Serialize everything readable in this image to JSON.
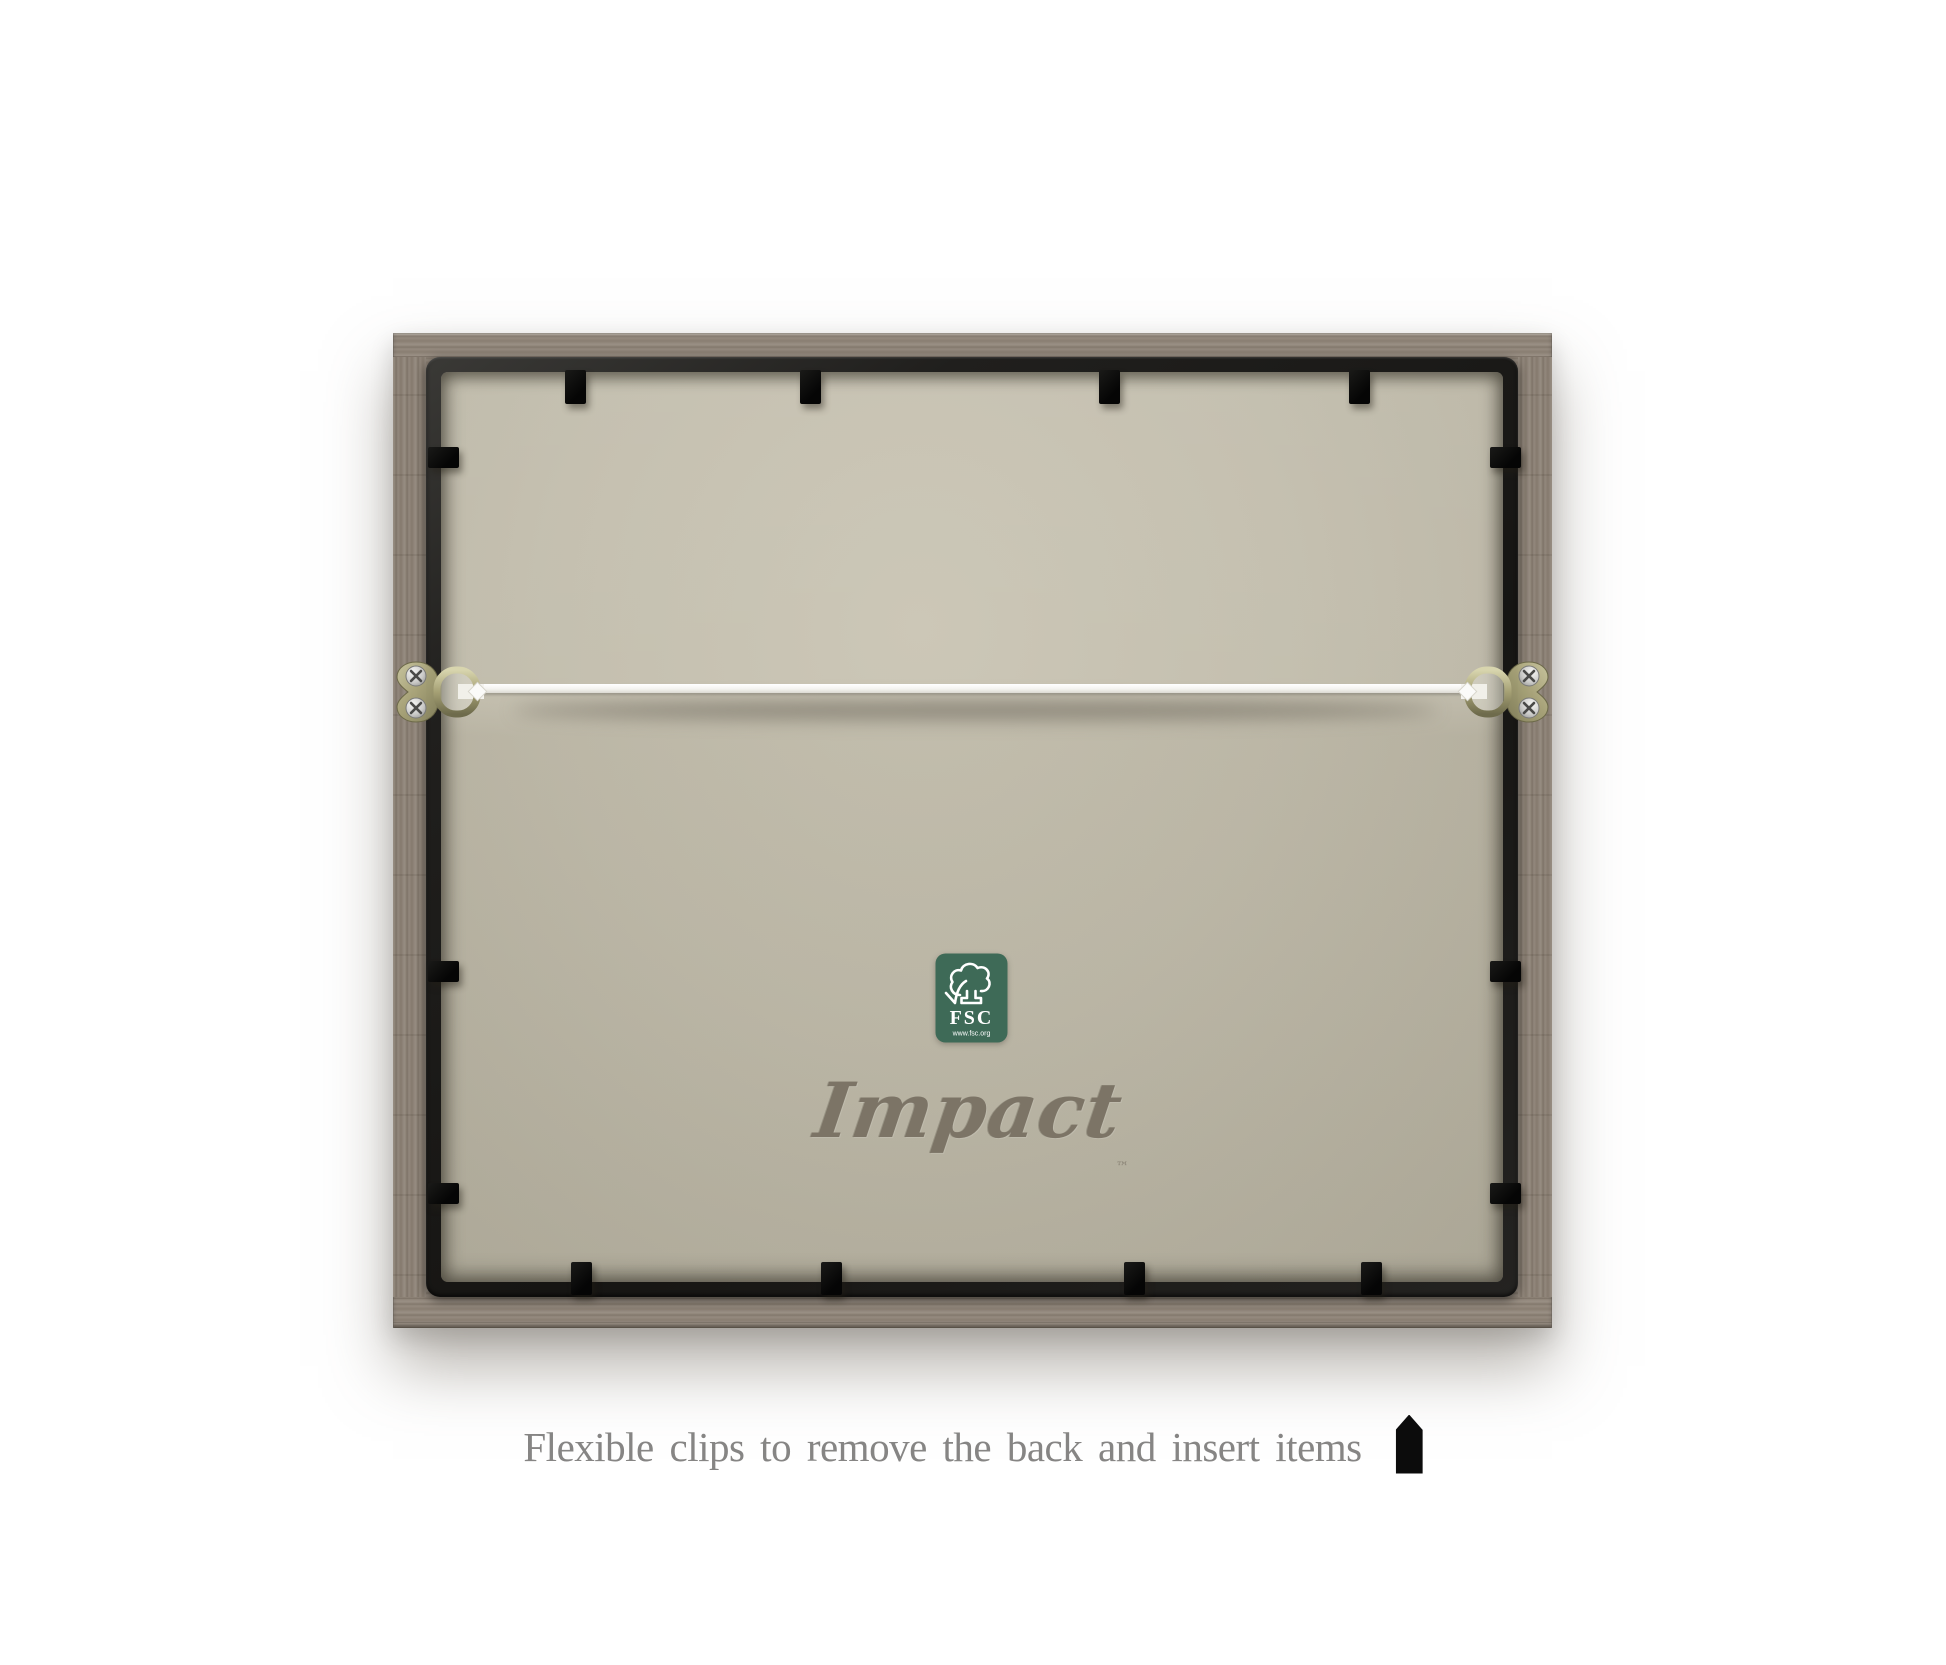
{
  "photo": {
    "subject": "Back view of a wooden picture frame with hanging hardware"
  },
  "branding": {
    "name": "Impact",
    "mark": "™"
  },
  "fsc_badge": {
    "acronym": "FSC",
    "website": "www.fsc.org"
  },
  "caption": {
    "text": "Flexible clips to remove the back and insert items"
  },
  "hardware": {
    "left_hanger": "d-ring-hanger",
    "right_hanger": "d-ring-hanger",
    "wire": "hanging-wire"
  },
  "clips": {
    "top": 4,
    "bottom": 4,
    "left": 3,
    "right": 3
  },
  "colors": {
    "background": "#ffffff",
    "wood": "#8f8478",
    "inner_frame": "#1e1d1b",
    "backing": "#c0bbaa",
    "fsc_green": "#3e6a57",
    "brand_text": "#7c7466",
    "caption_text": "#868584",
    "wire": "#f4f3ef",
    "hardware_brass": "#a9a479"
  }
}
